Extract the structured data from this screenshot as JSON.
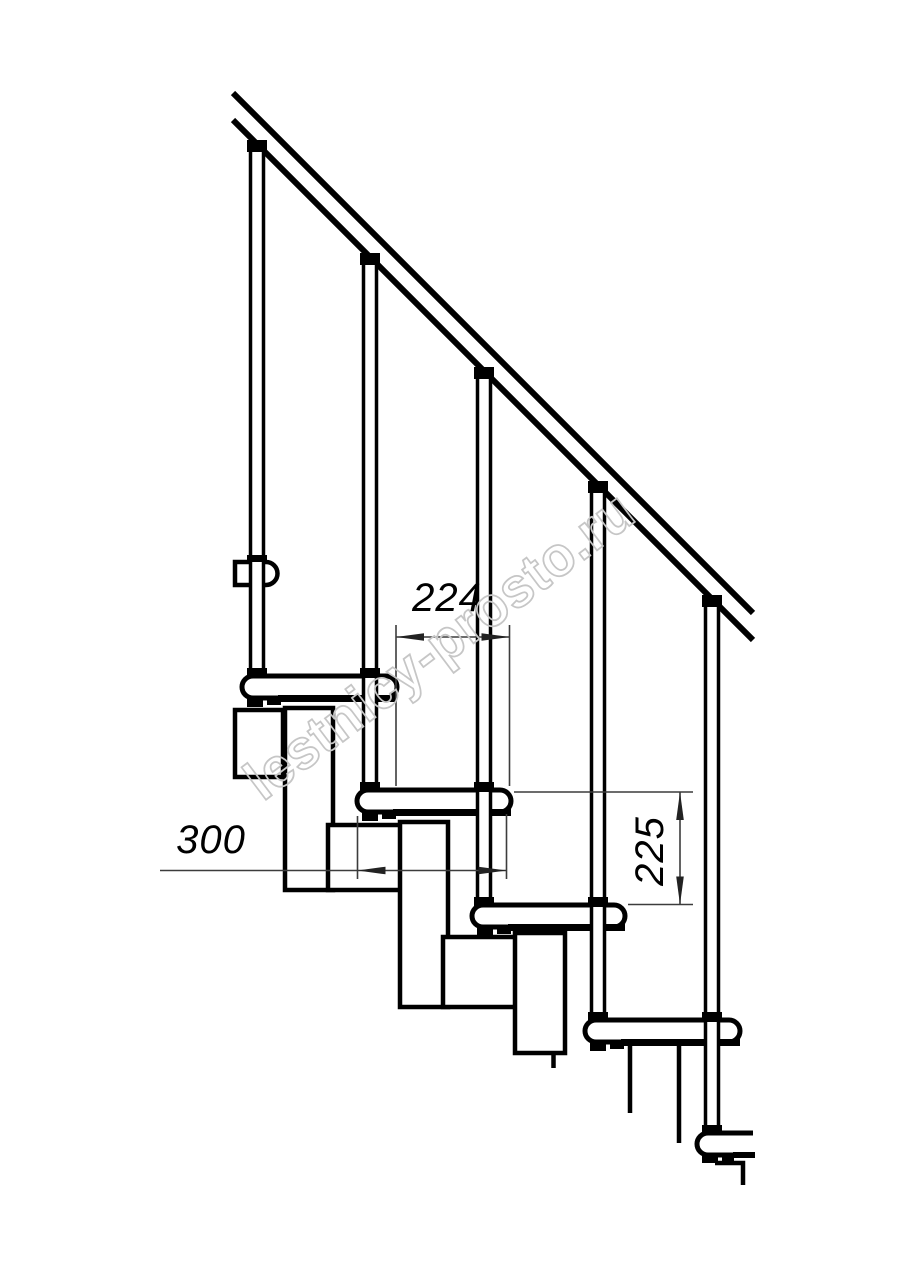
{
  "drawing": {
    "dimensions": {
      "tread_offset": "224",
      "tread_depth": "300",
      "step_rise": "225"
    },
    "watermark": "lestnicy-prosto.ru",
    "colors": {
      "line": "#000000",
      "dimension": "#3c3c3c",
      "watermark": "#c6c6c6",
      "background": "#ffffff"
    }
  }
}
